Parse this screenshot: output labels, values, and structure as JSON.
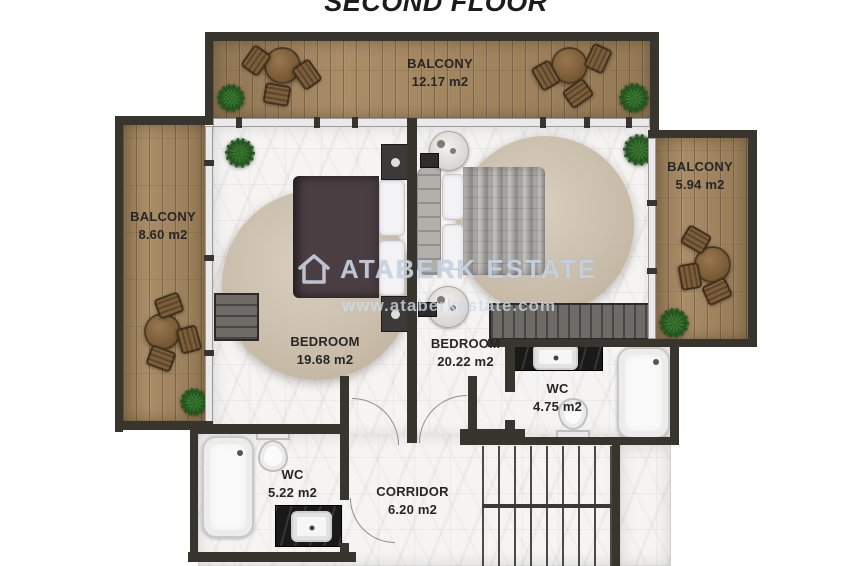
{
  "title": "SECOND FLOOR",
  "watermark": {
    "brand": "ATABERK ESTATE",
    "website": "www.ataberkestate.com"
  },
  "rooms": {
    "balcony_top": {
      "name": "BALCONY",
      "area": "12.17 m2"
    },
    "balcony_left": {
      "name": "BALCONY",
      "area": "8.60 m2"
    },
    "balcony_right": {
      "name": "BALCONY",
      "area": "5.94 m2"
    },
    "bedroom_left": {
      "name": "BEDROOM",
      "area": "19.68 m2"
    },
    "bedroom_right": {
      "name": "BEDROOM",
      "area": "20.22 m2"
    },
    "wc_right": {
      "name": "WC",
      "area": "4.75 m2"
    },
    "wc_left": {
      "name": "WC",
      "area": "5.22 m2"
    },
    "corridor": {
      "name": "CORRIDOR",
      "area": "6.20 m2"
    }
  },
  "colors": {
    "wall": "#38352f",
    "wood_floor": "#a5875f",
    "marble_floor": "#f5f4f2",
    "watermark_tint": "#d0dae8"
  }
}
